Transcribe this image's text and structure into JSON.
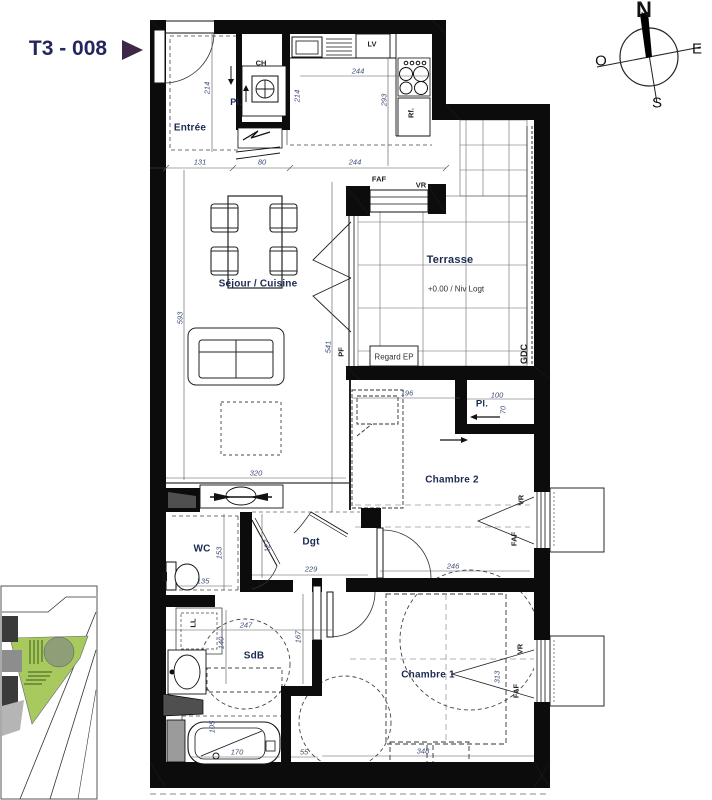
{
  "header": {
    "unit_label": "T3 - 008"
  },
  "compass": {
    "north": "N",
    "east": "E",
    "south": "S",
    "west": "O"
  },
  "rooms": {
    "entree": "Entrée",
    "sejour_cuisine": "Séjour / Cuisine",
    "terrasse": "Terrasse",
    "terrasse_level": "+0.00 / Niv Logt",
    "chambre1": "Chambre 1",
    "chambre2": "Chambre 2",
    "wc": "WC",
    "sdb": "SdB",
    "dgt": "Dgt"
  },
  "fixtures": {
    "pl_entree": "Pl.",
    "pl_chambre2": "Pl.",
    "ch": "CH",
    "lv": "LV",
    "rf": "Rf.",
    "ll": "LL",
    "gdc": "GDC",
    "pf": "PF",
    "regard_ep": "Regard EP"
  },
  "window_tags": {
    "faf_terrasse": "FAF",
    "vr_terrasse": "VR",
    "faf_chambre2": "FAF",
    "vr_chambre2": "VR",
    "faf_chambre1": "FAF",
    "vr_chambre1": "VR"
  },
  "dims": {
    "entree_height": "214",
    "entree_width": "131",
    "hall_width": "80",
    "kitchen_width": "244",
    "kitchen_inner_width": "244",
    "kitchen_depth": "214",
    "kitchen_height": "293",
    "sejour_height": "593",
    "pf_height": "541",
    "sejour_width": "320",
    "ch2_bed": "196",
    "pl2_width": "100",
    "pl2_depth": "70",
    "chambre2_width": "246",
    "wc_height": "153",
    "wc_width": "135",
    "wc_door": "127",
    "dgt_width": "229",
    "sdb_width": "247",
    "sdb_height": "140",
    "tub_length": "170",
    "tub_width": "105",
    "gap": "55",
    "sdb_door": "167",
    "chambre1_width": "348",
    "chambre1_window": "313"
  },
  "colors": {
    "unit_navy": "#26265e",
    "arrow_purple": "#3f2747",
    "label_navy": "#1c2a52",
    "dim_blue": "#3c4c78",
    "wall_black": "#0c0c0c",
    "map_green": "#a8c95e"
  }
}
